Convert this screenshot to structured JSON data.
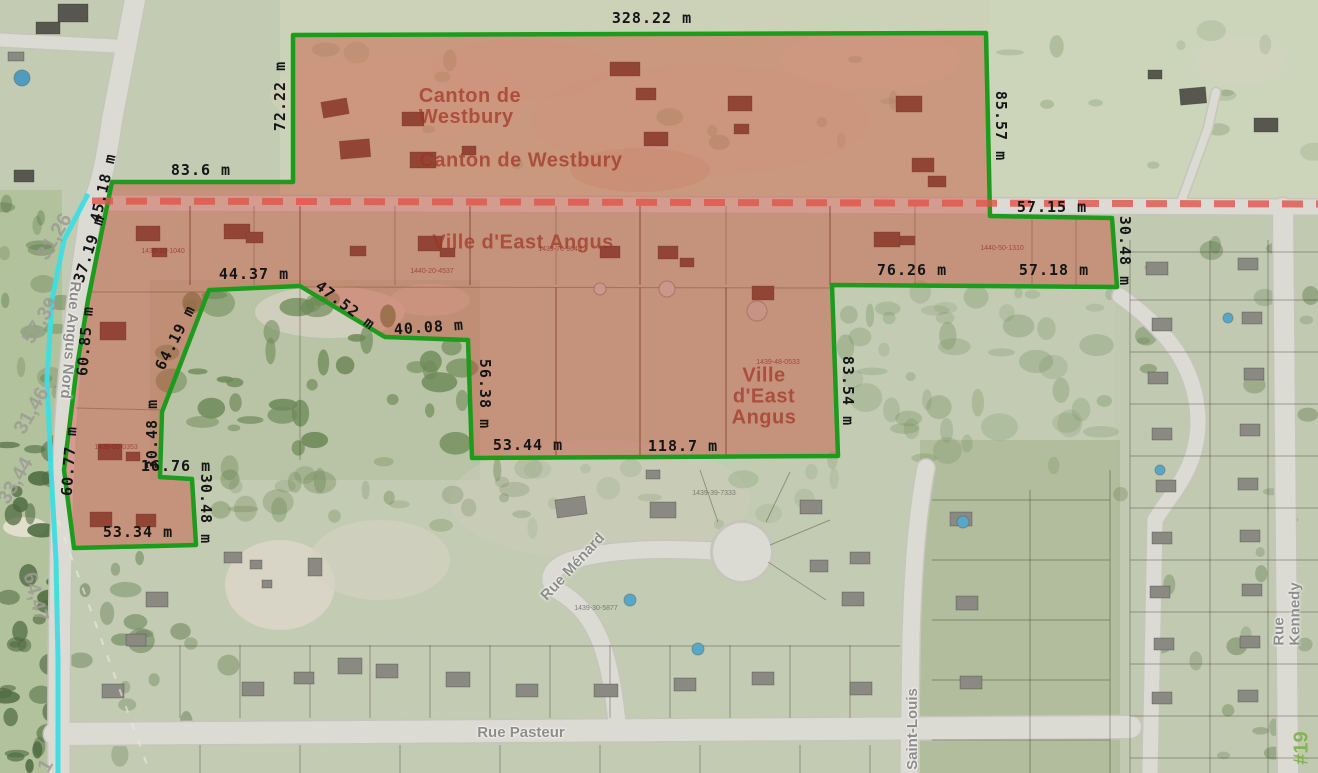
{
  "map": {
    "colors": {
      "highlight_fill": "rgba(201,62,43,0.40)",
      "boundary_stroke": "#1d9b1d",
      "municipal_dash": "#e2544a",
      "hydro_line": "#3fdde0",
      "road": "#dbdad3",
      "grass": "#c3ccb3"
    },
    "highlight_polygon": {
      "points": [
        [
          293,
          35
        ],
        [
          986,
          33
        ],
        [
          990,
          216
        ],
        [
          1112,
          218
        ],
        [
          1117,
          287
        ],
        [
          832,
          285
        ],
        [
          838,
          456
        ],
        [
          472,
          458
        ],
        [
          468,
          340
        ],
        [
          385,
          337
        ],
        [
          300,
          286
        ],
        [
          209,
          290
        ],
        [
          162,
          412
        ],
        [
          160,
          477
        ],
        [
          192,
          479
        ],
        [
          196,
          545
        ],
        [
          74,
          548
        ],
        [
          64,
          470
        ],
        [
          76,
          373
        ],
        [
          88,
          300
        ],
        [
          100,
          240
        ],
        [
          112,
          182
        ],
        [
          293,
          182
        ]
      ]
    },
    "municipal_boundary": {
      "x1": 92,
      "y1": 201,
      "x2": 1318,
      "y2": 204
    },
    "hydro_line": {
      "points": [
        [
          88,
          194
        ],
        [
          64,
          240
        ],
        [
          52,
          300
        ],
        [
          47,
          380
        ],
        [
          51,
          470
        ],
        [
          56,
          560
        ],
        [
          58,
          660
        ],
        [
          58,
          773
        ]
      ]
    },
    "labels": {
      "measurements": [
        {
          "t": "328.22 m",
          "x": 652,
          "y": 19,
          "r": 0
        },
        {
          "t": "72.22 m",
          "x": 281,
          "y": 96,
          "r": -90
        },
        {
          "t": "85.57 m",
          "x": 1000,
          "y": 126,
          "r": 90
        },
        {
          "t": "83.6 m",
          "x": 201,
          "y": 171,
          "r": 0
        },
        {
          "t": "45.18 m",
          "x": 104,
          "y": 188,
          "r": -77
        },
        {
          "t": "37.19 m",
          "x": 90,
          "y": 249,
          "r": -72
        },
        {
          "t": "57.15 m",
          "x": 1052,
          "y": 208,
          "r": 0
        },
        {
          "t": "30.48 m",
          "x": 1124,
          "y": 251,
          "r": 90
        },
        {
          "t": "57.18 m",
          "x": 1054,
          "y": 271,
          "r": 0
        },
        {
          "t": "76.26 m",
          "x": 912,
          "y": 271,
          "r": 0
        },
        {
          "t": "83.54 m",
          "x": 847,
          "y": 391,
          "r": 90
        },
        {
          "t": "118.7 m",
          "x": 683,
          "y": 447,
          "r": 0
        },
        {
          "t": "53.44 m",
          "x": 528,
          "y": 446,
          "r": 0
        },
        {
          "t": "56.38 m",
          "x": 484,
          "y": 394,
          "r": 90
        },
        {
          "t": "40.08 m",
          "x": 429,
          "y": 328,
          "r": -4
        },
        {
          "t": "47.52 m",
          "x": 345,
          "y": 306,
          "r": 37
        },
        {
          "t": "44.37 m",
          "x": 254,
          "y": 275,
          "r": 0
        },
        {
          "t": "64.19 m",
          "x": 176,
          "y": 338,
          "r": -63
        },
        {
          "t": "30.48 m",
          "x": 153,
          "y": 434,
          "r": -90
        },
        {
          "t": "16.76 m",
          "x": 176,
          "y": 467,
          "r": 0
        },
        {
          "t": "30.48 m",
          "x": 205,
          "y": 509,
          "r": 90
        },
        {
          "t": "53.34 m",
          "x": 138,
          "y": 533,
          "r": 0
        },
        {
          "t": "60.85 m",
          "x": 86,
          "y": 341,
          "r": -85
        },
        {
          "t": "60.77 m",
          "x": 70,
          "y": 461,
          "r": -86
        }
      ],
      "municipalities": [
        {
          "t": "Canton de\nWestbury",
          "x": 470,
          "y": 107,
          "r": 0,
          "align": "left"
        },
        {
          "t": "Canton de Westbury",
          "x": 521,
          "y": 161,
          "r": 0,
          "align": "center"
        },
        {
          "t": "Ville d'East Angus",
          "x": 523,
          "y": 243,
          "r": 0,
          "align": "center"
        },
        {
          "t": "Ville\nd'East\nAngus",
          "x": 764,
          "y": 397,
          "r": 0,
          "align": "center"
        }
      ],
      "streets": [
        {
          "t": "Rue Angus Nord",
          "x": 70,
          "y": 340,
          "r": 95
        },
        {
          "t": "Rue Ménard",
          "x": 573,
          "y": 567,
          "r": -47
        },
        {
          "t": "Rue Pasteur",
          "x": 521,
          "y": 733,
          "r": 0
        },
        {
          "t": "Saint-Louis",
          "x": 913,
          "y": 729,
          "r": -90
        },
        {
          "t": "Rue Kennedy",
          "x": 1287,
          "y": 614,
          "r": -90
        }
      ],
      "route_markers": [
        {
          "t": "#19",
          "x": 1302,
          "y": 748,
          "r": -90
        }
      ],
      "lot_frontages": [
        {
          "t": "31,26",
          "x": 55,
          "y": 237,
          "r": -60
        },
        {
          "t": "57,39",
          "x": 41,
          "y": 321,
          "r": -58
        },
        {
          "t": "31,46",
          "x": 32,
          "y": 411,
          "r": -60
        },
        {
          "t": "33,44",
          "x": 16,
          "y": 481,
          "r": -60
        },
        {
          "t": "64,47",
          "x": 35,
          "y": 597,
          "r": 75
        },
        {
          "t": "1",
          "x": 46,
          "y": 766,
          "r": -60
        }
      ],
      "parcel_ids": [
        {
          "t": "1439-10-1040",
          "x": 163,
          "y": 252,
          "c": "pidr"
        },
        {
          "t": "1439-70-9648",
          "x": 560,
          "y": 250,
          "c": "pidr"
        },
        {
          "t": "1440-20-4537",
          "x": 432,
          "y": 272,
          "c": "pidr"
        },
        {
          "t": "1440-50-1310",
          "x": 1002,
          "y": 249,
          "c": "pidr"
        },
        {
          "t": "1439-48-0533",
          "x": 778,
          "y": 363,
          "c": "pidr"
        },
        {
          "t": "1439-09-0353",
          "x": 116,
          "y": 448,
          "c": "pidr"
        },
        {
          "t": "1439-39-7333",
          "x": 714,
          "y": 494,
          "c": "pidg"
        },
        {
          "t": "1439-30-5877",
          "x": 596,
          "y": 609,
          "c": "pidg"
        }
      ]
    }
  }
}
